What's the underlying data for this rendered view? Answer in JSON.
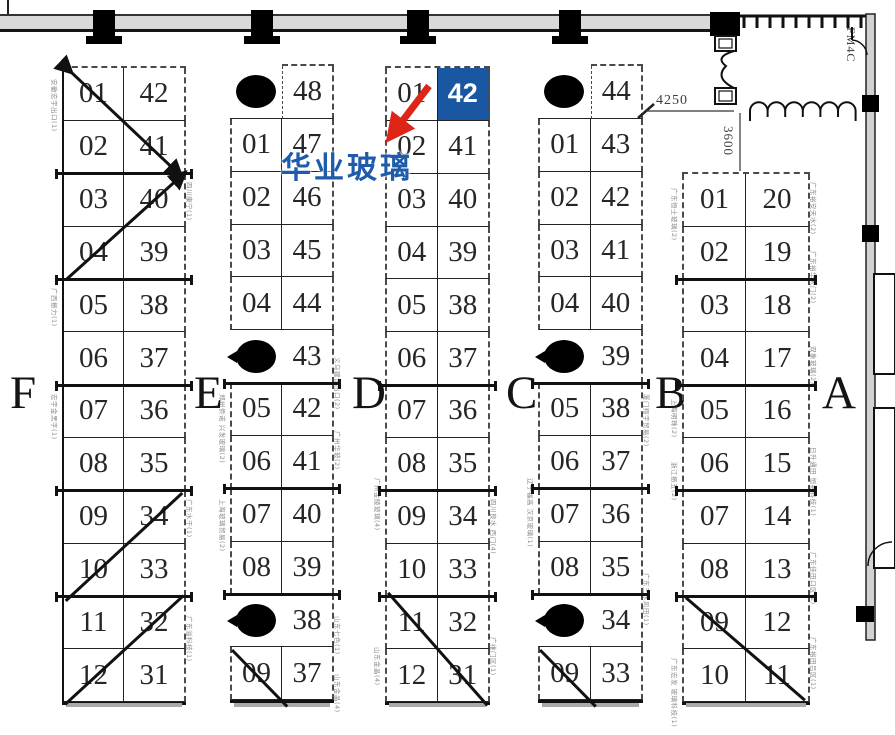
{
  "annotation": {
    "company_name": "华业玻璃",
    "highlight_booth": "42"
  },
  "dimensions": {
    "corridor_width": "4250",
    "corridor_depth": "3600",
    "door_code": "FM4C"
  },
  "colors": {
    "highlight_blue": "#1a57a3",
    "annotation_blue": "#1e5cab",
    "arrow_red": "#dd2417",
    "line_black": "#1a1a1a",
    "muted_label_gray": "#8c8c8c"
  },
  "zone_letters": [
    "F",
    "E",
    "D",
    "C",
    "B",
    "A"
  ],
  "zones": [
    {
      "id": "F",
      "letter": "F",
      "rows": [
        {
          "l": "01",
          "r": "42"
        },
        {
          "l": "02",
          "r": "41"
        },
        {
          "l": "03",
          "r": "40"
        },
        {
          "l": "04",
          "r": "39"
        },
        {
          "l": "05",
          "r": "38"
        },
        {
          "l": "06",
          "r": "37"
        },
        {
          "l": "07",
          "r": "36"
        },
        {
          "l": "08",
          "r": "35"
        },
        {
          "l": "09",
          "r": "34"
        },
        {
          "l": "10",
          "r": "33"
        },
        {
          "l": "11",
          "r": "32"
        },
        {
          "l": "12",
          "r": "31"
        }
      ],
      "bold_after": [
        2,
        4,
        6,
        8,
        10
      ],
      "strikes": [
        {
          "u1": 0.15,
          "y1": 0.12,
          "u2": 1.92,
          "y2": 2.08,
          "a1": true,
          "a2": true
        },
        {
          "u1": 0.06,
          "y1": 4.05,
          "u2": 1.98,
          "y2": 2.02,
          "a2": true
        },
        {
          "u1": 1.94,
          "y1": 8.08,
          "u2": 0.06,
          "y2": 10.12
        },
        {
          "u1": 1.96,
          "y1": 10.02,
          "u2": 0.05,
          "y2": 12.08
        }
      ],
      "side_labels": [
        {
          "side": "L",
          "row": 0.25,
          "text": "安徽宏宇出口(1)"
        },
        {
          "side": "L",
          "row": 4.2,
          "text": "广西振力(1)"
        },
        {
          "side": "L",
          "row": 6.2,
          "text": "宏宇金黑字(1)"
        },
        {
          "side": "R",
          "row": 2.2,
          "text": "四川康宁(1)"
        },
        {
          "side": "R",
          "row": 8.2,
          "text": "广东水干(1)"
        },
        {
          "side": "R",
          "row": 10.4,
          "text": "广东溢科技(1)"
        }
      ]
    },
    {
      "id": "E",
      "letter": "E",
      "rows": [
        {
          "p": 1,
          "r": "48"
        },
        {
          "l": "01",
          "r": "47"
        },
        {
          "l": "02",
          "r": "46"
        },
        {
          "l": "03",
          "r": "45"
        },
        {
          "l": "04",
          "r": "44"
        },
        {
          "p": 2,
          "r": "43"
        },
        {
          "l": "05",
          "r": "42"
        },
        {
          "l": "06",
          "r": "41"
        },
        {
          "l": "07",
          "r": "40"
        },
        {
          "l": "08",
          "r": "39"
        },
        {
          "p": 2,
          "r": "38"
        },
        {
          "l": "09",
          "r": "37"
        }
      ],
      "bold_after": [
        6,
        8,
        10
      ],
      "strikes": [
        {
          "u1": 0.04,
          "y1": 11.05,
          "u2": 1.1,
          "y2": 12.12
        }
      ],
      "side_labels": [
        {
          "side": "L",
          "row": 6.2,
          "text": "郑州侨诺 兴发玻璃(2)"
        },
        {
          "side": "L",
          "row": 8.2,
          "text": "上海玻璃贸易(2)"
        },
        {
          "side": "R",
          "row": 5.5,
          "text": "义乌建设出口(2)"
        },
        {
          "side": "R",
          "row": 6.9,
          "text": "广州华玻(2)"
        },
        {
          "side": "R",
          "row": 10.4,
          "text": "山东七色(1)"
        },
        {
          "side": "R",
          "row": 11.5,
          "text": "山东金晶(4)"
        }
      ]
    },
    {
      "id": "D",
      "letter": "D",
      "rows": [
        {
          "l": "01",
          "r": "42",
          "hl": true
        },
        {
          "l": "02",
          "r": "41"
        },
        {
          "l": "03",
          "r": "40"
        },
        {
          "l": "04",
          "r": "39"
        },
        {
          "l": "05",
          "r": "38"
        },
        {
          "l": "06",
          "r": "37"
        },
        {
          "l": "07",
          "r": "36"
        },
        {
          "l": "08",
          "r": "35"
        },
        {
          "l": "09",
          "r": "34"
        },
        {
          "l": "10",
          "r": "33"
        },
        {
          "l": "11",
          "r": "32"
        },
        {
          "l": "12",
          "r": "31"
        }
      ],
      "bold_after": [
        6,
        8,
        10
      ],
      "strikes": [
        {
          "u1": 0.06,
          "y1": 9.97,
          "u2": 1.95,
          "y2": 12.1
        }
      ],
      "side_labels": [
        {
          "side": "L",
          "row": 7.8,
          "text": "广州金陵玻璃(4)"
        },
        {
          "side": "L",
          "row": 11.0,
          "text": "山东金晶(4)"
        },
        {
          "side": "R",
          "row": 8.2,
          "text": "四川良水 西门(4)"
        },
        {
          "side": "R",
          "row": 10.8,
          "text": "广维门区(1)"
        }
      ]
    },
    {
      "id": "C",
      "letter": "C",
      "rows": [
        {
          "p": 1,
          "r": "44"
        },
        {
          "l": "01",
          "r": "43"
        },
        {
          "l": "02",
          "r": "42"
        },
        {
          "l": "03",
          "r": "41"
        },
        {
          "l": "04",
          "r": "40"
        },
        {
          "p": 2,
          "r": "39"
        },
        {
          "l": "05",
          "r": "38"
        },
        {
          "l": "06",
          "r": "37"
        },
        {
          "l": "07",
          "r": "36"
        },
        {
          "l": "08",
          "r": "35"
        },
        {
          "p": 2,
          "r": "34"
        },
        {
          "l": "09",
          "r": "33"
        }
      ],
      "bold_after": [
        6,
        8,
        10
      ],
      "strikes": [
        {
          "u1": 0.04,
          "y1": 11.05,
          "u2": 1.1,
          "y2": 12.12
        }
      ],
      "side_labels": [
        {
          "side": "L",
          "row": 7.8,
          "text": "辽宁福高 汉京玻璃(1)"
        },
        {
          "side": "R",
          "row": 6.2,
          "text": "厦门翔宇贸易(2)"
        },
        {
          "side": "R",
          "row": 9.6,
          "text": "广东三水风田(1)"
        }
      ]
    },
    {
      "id": "B",
      "letter": "B",
      "rows": [
        {
          "l": "01",
          "r": "20"
        },
        {
          "l": "02",
          "r": "19"
        },
        {
          "l": "03",
          "r": "18"
        },
        {
          "l": "04",
          "r": "17"
        },
        {
          "l": "05",
          "r": "16"
        },
        {
          "l": "06",
          "r": "15"
        },
        {
          "l": "07",
          "r": "14"
        },
        {
          "l": "08",
          "r": "13"
        },
        {
          "l": "09",
          "r": "12"
        },
        {
          "l": "10",
          "r": "11"
        }
      ],
      "bold_after": [
        2,
        4,
        6,
        8
      ],
      "strikes": [
        {
          "u1": 0.06,
          "y1": 8.06,
          "u2": 1.92,
          "y2": 10.0
        }
      ],
      "side_labels": [
        {
          "side": "L",
          "row": 0.3,
          "text": "广东恒士玻璃(2)"
        },
        {
          "side": "L",
          "row": 4.3,
          "text": "上海明珠(2)"
        },
        {
          "side": "L",
          "row": 5.5,
          "text": "浙江振五(2)"
        },
        {
          "side": "L",
          "row": 9.2,
          "text": "广东宏发 玻璃科技(1)"
        },
        {
          "side": "R",
          "row": 0.2,
          "text": "广东裕安天水(2)"
        },
        {
          "side": "R",
          "row": 1.5,
          "text": "广东裕华天门(2)"
        },
        {
          "side": "R",
          "row": 3.3,
          "text": "双象玻璃(2)"
        },
        {
          "side": "R",
          "row": 5.2,
          "text": "日升通田 恒裕科技(1)"
        },
        {
          "side": "R",
          "row": 7.2,
          "text": "广东佳田口区(2)"
        },
        {
          "side": "R",
          "row": 8.8,
          "text": "广东裕田吕区(1)"
        }
      ]
    }
  ]
}
